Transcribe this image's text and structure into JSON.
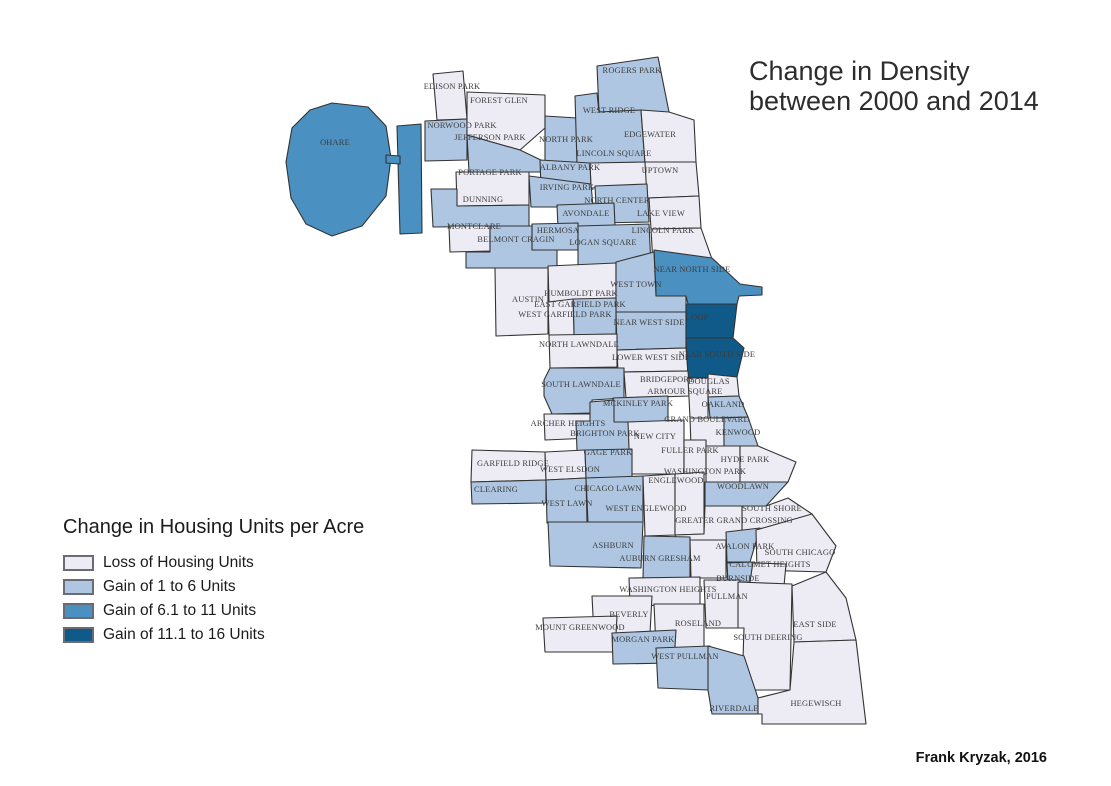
{
  "title": {
    "line1": "Change in Density",
    "line2": "between 2000 and 2014"
  },
  "legend": {
    "title": "Change in Housing Units per Acre",
    "items": [
      {
        "label": "Loss of Housing Units",
        "color": "#edecf4"
      },
      {
        "label": "Gain of 1 to 6 Units",
        "color": "#aec6e1"
      },
      {
        "label": "Gain of 6.1 to 11 Units",
        "color": "#4a90c1"
      },
      {
        "label": "Gain of 11.1 to 16 Units",
        "color": "#0f5a88"
      }
    ]
  },
  "attribution": "Frank Kryzak, 2016",
  "map": {
    "stroke": "#333333",
    "label_color": "#3c3c3c",
    "areas": [
      {
        "name": "O'Hare",
        "label": "OHARE",
        "class": 2,
        "label_x": 335,
        "label_y": 142,
        "points": "332,103 368,107 386,126 391,158 386,196 362,226 332,236 306,224 291,198 286,162 292,128 310,110"
      },
      {
        "name": "O'Hare annex",
        "label": "",
        "class": 2,
        "label_x": 0,
        "label_y": 0,
        "points": "397,126 421,124 422,233 400,234"
      },
      {
        "name": "O'Hare bridge",
        "label": "",
        "class": 2,
        "label_x": 0,
        "label_y": 0,
        "points": "386,155 400,156 400,164 386,163"
      },
      {
        "name": "Edison Park",
        "label": "EDISON PARK",
        "class": 0,
        "label_x": 452,
        "label_y": 86,
        "points": "433,74 463,71 467,119 437,120"
      },
      {
        "name": "Norwood Park",
        "label": "NORWOOD PARK",
        "class": 1,
        "label_x": 462,
        "label_y": 125,
        "points": "425,121 467,119 467,160 425,161"
      },
      {
        "name": "Forest Glen",
        "label": "FOREST GLEN",
        "class": 0,
        "label_x": 499,
        "label_y": 100,
        "points": "467,92 545,95 545,128 520,150 467,135"
      },
      {
        "name": "North Park",
        "label": "NORTH PARK",
        "class": 1,
        "label_x": 566,
        "label_y": 139,
        "points": "545,116 577,118 577,163 545,162"
      },
      {
        "name": "Jefferson Park",
        "label": "JEFFERSON PARK",
        "class": 1,
        "label_x": 490,
        "label_y": 137,
        "points": "467,135 520,150 545,162 545,172 469,172"
      },
      {
        "name": "Rogers Park",
        "label": "ROGERS PARK",
        "class": 1,
        "label_x": 632,
        "label_y": 70,
        "points": "597,66 658,57 669,112 599,112"
      },
      {
        "name": "West Ridge",
        "label": "WEST RIDGE",
        "class": 1,
        "label_x": 609,
        "label_y": 110,
        "points": "575,96 597,93 599,112 641,110 645,163 577,164"
      },
      {
        "name": "Edgewater",
        "label": "EDGEWATER",
        "class": 0,
        "label_x": 650,
        "label_y": 134,
        "points": "641,110 669,112 694,120 696,162 645,163"
      },
      {
        "name": "Lincoln Square",
        "label": "LINCOLN SQUARE",
        "class": 0,
        "label_x": 614,
        "label_y": 153,
        "points": "590,163 645,162 647,187 591,188"
      },
      {
        "name": "Albany Park",
        "label": "ALBANY PARK",
        "class": 1,
        "label_x": 570,
        "label_y": 167,
        "points": "540,160 590,163 591,188 541,188"
      },
      {
        "name": "Uptown",
        "label": "UPTOWN",
        "class": 0,
        "label_x": 660,
        "label_y": 170,
        "points": "645,162 696,162 699,196 647,198"
      },
      {
        "name": "Portage Park",
        "label": "PORTAGE PARK",
        "class": 0,
        "label_x": 490,
        "label_y": 172,
        "points": "456,172 529,172 529,205 457,206"
      },
      {
        "name": "Irving Park",
        "label": "IRVING PARK",
        "class": 1,
        "label_x": 567,
        "label_y": 187,
        "points": "529,176 591,184 593,207 531,207"
      },
      {
        "name": "Dunning",
        "label": "DUNNING",
        "class": 1,
        "label_x": 483,
        "label_y": 199,
        "points": "431,189 457,189 457,206 529,205 529,226 433,227"
      },
      {
        "name": "North Center",
        "label": "NORTH CENTER",
        "class": 1,
        "label_x": 617,
        "label_y": 200,
        "points": "595,186 647,184 649,222 597,223"
      },
      {
        "name": "Lake View",
        "label": "LAKE VIEW",
        "class": 0,
        "label_x": 661,
        "label_y": 213,
        "points": "649,198 699,196 701,228 651,229"
      },
      {
        "name": "Avondale",
        "label": "AVONDALE",
        "class": 1,
        "label_x": 586,
        "label_y": 213,
        "points": "557,205 614,203 615,226 558,227"
      },
      {
        "name": "Montclare",
        "label": "MONTCLARE",
        "class": 0,
        "label_x": 474,
        "label_y": 226,
        "points": "449,226 490,226 490,251 450,252"
      },
      {
        "name": "Hermosa",
        "label": "HERMOSA",
        "class": 1,
        "label_x": 558,
        "label_y": 230,
        "points": "532,224 578,223 578,250 532,250"
      },
      {
        "name": "Lincoln Park",
        "label": "LINCOLN PARK",
        "class": 0,
        "label_x": 663,
        "label_y": 230,
        "points": "651,229 701,228 713,262 653,264"
      },
      {
        "name": "Belmont Cragin",
        "label": "BELMONT CRAGIN",
        "class": 1,
        "label_x": 516,
        "label_y": 239,
        "points": "490,226 532,226 532,250 557,250 557,268 466,268 466,252 490,252"
      },
      {
        "name": "Logan Square",
        "label": "LOGAN SQUARE",
        "class": 1,
        "label_x": 603,
        "label_y": 242,
        "points": "578,226 649,224 651,266 578,268"
      },
      {
        "name": "Near North Side",
        "label": "NEAR NORTH SIDE",
        "class": 2,
        "label_x": 692,
        "label_y": 269,
        "points": "654,250 712,258 740,284 762,287 762,295 739,296 737,304 688,304 686,296 656,296"
      },
      {
        "name": "Humboldt Park",
        "label": "HUMBOLDT PARK",
        "class": 0,
        "label_x": 581,
        "label_y": 293,
        "points": "548,266 616,263 616,300 549,302"
      },
      {
        "name": "West Town",
        "label": "WEST TOWN",
        "class": 1,
        "label_x": 636,
        "label_y": 284,
        "points": "616,262 654,252 656,296 686,296 686,312 616,312"
      },
      {
        "name": "Austin",
        "label": "AUSTIN",
        "class": 0,
        "label_x": 528,
        "label_y": 299,
        "points": "495,268 548,268 548,334 496,336"
      },
      {
        "name": "East Garfield Park",
        "label": "EAST GARFIELD PARK",
        "class": 1,
        "label_x": 580,
        "label_y": 304,
        "points": "573,299 616,298 616,334 574,335"
      },
      {
        "name": "West Garfield Park",
        "label": "WEST GARFIELD PARK",
        "class": 0,
        "label_x": 565,
        "label_y": 314,
        "points": "548,302 573,299 574,335 549,335"
      },
      {
        "name": "Near West Side",
        "label": "NEAR WEST SIDE",
        "class": 1,
        "label_x": 649,
        "label_y": 322,
        "points": "616,312 686,312 686,348 617,350"
      },
      {
        "name": "Loop",
        "label": "LOOP",
        "class": 3,
        "label_x": 697,
        "label_y": 317,
        "points": "686,304 737,304 733,338 686,338"
      },
      {
        "name": "North Lawndale",
        "label": "NORTH LAWNDALE",
        "class": 0,
        "label_x": 579,
        "label_y": 344,
        "points": "549,335 617,334 617,367 550,368"
      },
      {
        "name": "Lower West Side",
        "label": "LOWER WEST SIDE",
        "class": 0,
        "label_x": 651,
        "label_y": 357,
        "points": "617,350 686,348 688,371 618,372"
      },
      {
        "name": "Near South Side",
        "label": "NEAR SOUTH SIDE",
        "class": 3,
        "label_x": 717,
        "label_y": 354,
        "points": "686,338 733,338 744,348 737,377 688,378"
      },
      {
        "name": "South Lawndale",
        "label": "SOUTH LAWNDALE",
        "class": 1,
        "label_x": 581,
        "label_y": 384,
        "points": "550,368 624,368 624,398 592,400 592,413 552,414 544,396 544,380"
      },
      {
        "name": "Bridgeport",
        "label": "BRIDGEPORT",
        "class": 0,
        "label_x": 667,
        "label_y": 379,
        "points": "624,372 688,371 690,396 626,398"
      },
      {
        "name": "Armour Square",
        "label": "ARMOUR SQUARE",
        "class": 0,
        "label_x": 685,
        "label_y": 391,
        "points": "688,378 708,378 708,418 690,418"
      },
      {
        "name": "Douglas",
        "label": "DOUGLAS",
        "class": 0,
        "label_x": 709,
        "label_y": 381,
        "points": "708,374 737,377 739,396 708,397"
      },
      {
        "name": "McKinley Park",
        "label": "MCKINLEY PARK",
        "class": 1,
        "label_x": 638,
        "label_y": 403,
        "points": "613,398 668,396 668,422 614,423"
      },
      {
        "name": "Oakland",
        "label": "OAKLAND",
        "class": 1,
        "label_x": 723,
        "label_y": 404,
        "points": "708,397 739,396 748,417 710,418"
      },
      {
        "name": "Grand Boulevard",
        "label": "GRAND BOULEVARD",
        "class": 0,
        "label_x": 707,
        "label_y": 419,
        "points": "690,418 724,418 724,446 691,446"
      },
      {
        "name": "Kenwood",
        "label": "KENWOOD",
        "class": 1,
        "label_x": 738,
        "label_y": 432,
        "points": "724,418 748,417 758,446 724,446"
      },
      {
        "name": "Archer Heights",
        "label": "ARCHER HEIGHTS",
        "class": 0,
        "label_x": 568,
        "label_y": 423,
        "points": "544,414 592,414 592,438 545,440"
      },
      {
        "name": "Brighton Park",
        "label": "BRIGHTON PARK",
        "class": 1,
        "label_x": 605,
        "label_y": 433,
        "points": "590,402 614,400 614,422 630,422 631,450 577,451 576,421 590,421"
      },
      {
        "name": "New City",
        "label": "NEW CITY",
        "class": 0,
        "label_x": 655,
        "label_y": 436,
        "points": "628,422 684,420 684,474 630,474"
      },
      {
        "name": "Fuller Park",
        "label": "FULLER PARK",
        "class": 0,
        "label_x": 690,
        "label_y": 450,
        "points": "684,440 706,440 706,474 684,474"
      },
      {
        "name": "Washington Park",
        "label": "WASHINGTON PARK",
        "class": 0,
        "label_x": 705,
        "label_y": 471,
        "points": "706,446 740,446 740,482 706,482"
      },
      {
        "name": "Hyde Park",
        "label": "HYDE PARK",
        "class": 0,
        "label_x": 745,
        "label_y": 459,
        "points": "740,446 758,446 796,462 788,482 740,482"
      },
      {
        "name": "Garfield Ridge",
        "label": "GARFIELD RIDGE",
        "class": 0,
        "label_x": 513,
        "label_y": 463,
        "points": "472,450 545,452 546,480 471,482"
      },
      {
        "name": "West Elsdon",
        "label": "WEST ELSDON",
        "class": 0,
        "label_x": 570,
        "label_y": 469,
        "points": "545,452 585,450 586,478 546,480"
      },
      {
        "name": "Gage Park",
        "label": "GAGE PARK",
        "class": 1,
        "label_x": 608,
        "label_y": 452,
        "points": "585,450 632,449 632,477 586,478"
      },
      {
        "name": "Clearing",
        "label": "CLEARING",
        "class": 1,
        "label_x": 496,
        "label_y": 489,
        "points": "471,482 546,480 546,503 472,504"
      },
      {
        "name": "West Lawn",
        "label": "WEST LAWN",
        "class": 1,
        "label_x": 567,
        "label_y": 503,
        "points": "546,480 586,478 587,522 547,523"
      },
      {
        "name": "Chicago Lawn",
        "label": "CHICAGO LAWN",
        "class": 1,
        "label_x": 608,
        "label_y": 488,
        "points": "586,478 643,476 643,522 588,523"
      },
      {
        "name": "West Englewood",
        "label": "WEST ENGLEWOOD",
        "class": 0,
        "label_x": 646,
        "label_y": 508,
        "points": "643,476 675,474 675,535 645,536"
      },
      {
        "name": "Englewood",
        "label": "ENGLEWOOD",
        "class": 0,
        "label_x": 676,
        "label_y": 480,
        "points": "675,474 704,472 704,534 675,535"
      },
      {
        "name": "Woodlawn",
        "label": "WOODLAWN",
        "class": 1,
        "label_x": 743,
        "label_y": 486,
        "points": "705,482 788,482 766,506 705,506"
      },
      {
        "name": "South Shore",
        "label": "SOUTH SHORE",
        "class": 0,
        "label_x": 772,
        "label_y": 508,
        "points": "742,506 766,506 788,498 812,514 794,532 742,532"
      },
      {
        "name": "Greater Grand Crossing",
        "label": "GREATER GRAND CROSSING",
        "class": 0,
        "label_x": 734,
        "label_y": 520,
        "points": "675,535 704,534 705,506 742,506 742,532 740,540 677,541"
      },
      {
        "name": "Ashburn",
        "label": "ASHBURN",
        "class": 1,
        "label_x": 613,
        "label_y": 545,
        "points": "548,522 643,522 641,568 550,566"
      },
      {
        "name": "Auburn Gresham",
        "label": "AUBURN GRESHAM",
        "class": 1,
        "label_x": 660,
        "label_y": 558,
        "points": "644,536 690,537 690,578 643,578"
      },
      {
        "name": "Chatham",
        "label": "",
        "class": 0,
        "label_x": 0,
        "label_y": 0,
        "points": "690,540 726,540 726,578 691,578"
      },
      {
        "name": "Avalon Park",
        "label": "AVALON PARK",
        "class": 1,
        "label_x": 745,
        "label_y": 546,
        "points": "726,532 760,528 750,562 727,562"
      },
      {
        "name": "South Chicago",
        "label": "SOUTH CHICAGO",
        "class": 0,
        "label_x": 800,
        "label_y": 552,
        "points": "756,530 812,514 836,546 826,572 757,570"
      },
      {
        "name": "Calumet Heights",
        "label": "CALUMET HEIGHTS",
        "class": 0,
        "label_x": 770,
        "label_y": 564,
        "points": "727,562 786,564 784,586 728,586"
      },
      {
        "name": "Burnside",
        "label": "BURNSIDE",
        "class": 1,
        "label_x": 738,
        "label_y": 578,
        "points": "727,563 753,562 750,582 728,582"
      },
      {
        "name": "Washington Heights",
        "label": "WASHINGTON HEIGHTS",
        "class": 0,
        "label_x": 668,
        "label_y": 589,
        "points": "629,578 700,577 700,604 630,606"
      },
      {
        "name": "Pullman",
        "label": "PULLMAN",
        "class": 0,
        "label_x": 727,
        "label_y": 596,
        "points": "704,580 740,580 738,628 706,628"
      },
      {
        "name": "Roseland",
        "label": "ROSELAND",
        "class": 0,
        "label_x": 698,
        "label_y": 623,
        "points": "654,604 704,604 704,648 656,648"
      },
      {
        "name": "Beverly",
        "label": "BEVERLY",
        "class": 0,
        "label_x": 629,
        "label_y": 614,
        "points": "592,596 652,596 650,633 594,635"
      },
      {
        "name": "Mount Greenwood",
        "label": "MOUNT GREENWOOD",
        "class": 0,
        "label_x": 580,
        "label_y": 627,
        "points": "543,618 617,616 615,652 545,652"
      },
      {
        "name": "Morgan Park",
        "label": "MORGAN PARK",
        "class": 1,
        "label_x": 643,
        "label_y": 639,
        "points": "612,633 676,630 674,663 613,664"
      },
      {
        "name": "South Deering",
        "label": "SOUTH DEERING",
        "class": 0,
        "label_x": 768,
        "label_y": 637,
        "points": "738,582 792,584 790,690 742,690 744,628 738,628"
      },
      {
        "name": "East Side",
        "label": "EAST SIDE",
        "class": 0,
        "label_x": 815,
        "label_y": 624,
        "points": "792,586 826,572 846,598 856,640 794,642"
      },
      {
        "name": "West Pullman",
        "label": "WEST PULLMAN",
        "class": 1,
        "label_x": 685,
        "label_y": 656,
        "points": "656,648 710,646 708,690 658,688"
      },
      {
        "name": "Riverdale",
        "label": "RIVERDALE",
        "class": 1,
        "label_x": 734,
        "label_y": 708,
        "points": "708,646 744,656 758,698 758,714 712,714 708,690"
      },
      {
        "name": "Hegewisch",
        "label": "HEGEWISCH",
        "class": 0,
        "label_x": 816,
        "label_y": 703,
        "points": "794,642 856,640 866,724 762,724 762,714 758,714 758,698 790,690"
      }
    ]
  }
}
